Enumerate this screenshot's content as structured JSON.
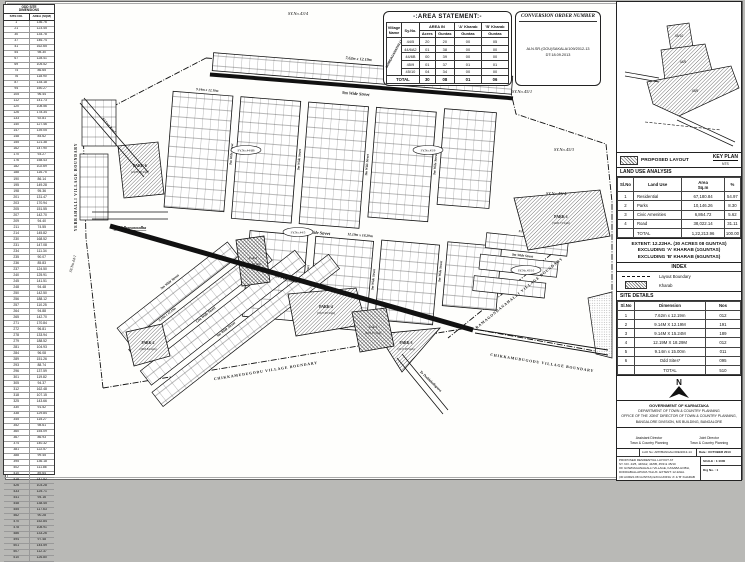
{
  "left_table": {
    "title_l1": "ODD SITE",
    "title_l2": "DIMENSIONS",
    "col_site": "SITE NO.",
    "col_area": "AREA (SQM)",
    "rows": [
      [
        "1",
        "136.76"
      ],
      [
        "21",
        "123.45"
      ],
      [
        "30",
        "134.78"
      ],
      [
        "37",
        "146.74"
      ],
      [
        "41",
        "162.65"
      ],
      [
        "54",
        "98.30"
      ],
      [
        "67",
        "128.41"
      ],
      [
        "69",
        "105.52"
      ],
      [
        "74",
        "86.65"
      ],
      [
        "76",
        "118.90"
      ],
      [
        "87",
        "134.18"
      ],
      [
        "94",
        "150.27"
      ],
      [
        "105",
        "96.44"
      ],
      [
        "112",
        "141.73"
      ],
      [
        "120",
        "108.56"
      ],
      [
        "126",
        "178.34"
      ],
      [
        "133",
        "92.81"
      ],
      [
        "140",
        "127.46"
      ],
      [
        "147",
        "139.05"
      ],
      [
        "148",
        "84.62"
      ],
      [
        "155",
        "121.38"
      ],
      [
        "162",
        "147.90"
      ],
      [
        "170",
        "93.27"
      ],
      [
        "176",
        "158.43"
      ],
      [
        "182",
        "102.69"
      ],
      [
        "188",
        "116.75"
      ],
      [
        "190",
        "86.14"
      ],
      [
        "195",
        "149.28"
      ],
      [
        "198",
        "95.36"
      ],
      [
        "201",
        "131.47"
      ],
      [
        "203",
        "170.94"
      ],
      [
        "205",
        "151.55"
      ],
      [
        "207",
        "142.70"
      ],
      [
        "209",
        "94.40"
      ],
      [
        "211",
        "74.55"
      ],
      [
        "214",
        "145.82"
      ],
      [
        "230",
        "168.52"
      ],
      [
        "231",
        "147.08"
      ],
      [
        "234",
        "111.34"
      ],
      [
        "235",
        "90.07"
      ],
      [
        "236",
        "85.83"
      ],
      [
        "237",
        "124.50"
      ],
      [
        "240",
        "125.91"
      ],
      [
        "245",
        "141.51"
      ],
      [
        "248",
        "94.48"
      ],
      [
        "250",
        "142.50"
      ],
      [
        "256",
        "188.12"
      ],
      [
        "257",
        "110.25"
      ],
      [
        "264",
        "94.88"
      ],
      [
        "265",
        "142.70"
      ],
      [
        "271",
        "170.84"
      ],
      [
        "272",
        "96.81"
      ],
      [
        "278",
        "133.94"
      ],
      [
        "279",
        "188.52"
      ],
      [
        "281",
        "104.93"
      ],
      [
        "284",
        "96.08"
      ],
      [
        "289",
        "151.26"
      ],
      [
        "293",
        "88.74"
      ],
      [
        "296",
        "137.59"
      ],
      [
        "301",
        "119.82"
      ],
      [
        "305",
        "94.37"
      ],
      [
        "312",
        "162.48"
      ],
      [
        "318",
        "107.15"
      ],
      [
        "325",
        "143.66"
      ],
      [
        "330",
        "91.52"
      ],
      [
        "338",
        "129.84"
      ],
      [
        "345",
        "115.27"
      ],
      [
        "352",
        "98.61"
      ],
      [
        "360",
        "154.09"
      ],
      [
        "367",
        "86.93"
      ],
      [
        "374",
        "140.32"
      ],
      [
        "381",
        "122.57"
      ],
      [
        "388",
        "99.45"
      ],
      [
        "395",
        "136.18"
      ],
      [
        "402",
        "111.86"
      ],
      [
        "410",
        "89.64"
      ],
      [
        "418",
        "147.52"
      ],
      [
        "426",
        "103.28"
      ],
      [
        "433",
        "125.71"
      ],
      [
        "441",
        "94.16"
      ],
      [
        "448",
        "138.45"
      ],
      [
        "455",
        "117.63"
      ],
      [
        "462",
        "90.28"
      ],
      [
        "470",
        "152.84"
      ],
      [
        "478",
        "108.91"
      ],
      [
        "486",
        "133.26"
      ],
      [
        "494",
        "97.48"
      ],
      [
        "501",
        "144.59"
      ],
      [
        "507",
        "112.37"
      ],
      [
        "510",
        "126.80"
      ]
    ]
  },
  "area_statement": {
    "title": "-:AREA STATEMENT:-",
    "col_village": "Village Name",
    "col_syno": "Sy.No.",
    "col_area_in": "AREA IN",
    "col_a_kharab": "'A' Kharab",
    "col_b_kharab": "'B' Kharab",
    "col_acres": "Acres",
    "col_guntas": "Guntas",
    "village": "GOWDAGANAHALLI",
    "rows": [
      [
        "44/5",
        "20",
        "20",
        "00",
        "05"
      ],
      [
        "44/6A2",
        "01",
        "38",
        "00",
        "00"
      ],
      [
        "44/6B",
        "00",
        "39",
        "00",
        "00"
      ],
      [
        "45/9",
        "01",
        "37",
        "01",
        "01"
      ],
      [
        "45/10",
        "04",
        "34",
        "00",
        "00"
      ],
      [
        "TOTAL",
        "30",
        "08",
        "01",
        "06"
      ]
    ]
  },
  "conversion_order": {
    "title": "CONVERSION ORDER NUMBER",
    "text": "ALN.SR.(GOU)SAKALA/109/2012-13 DT:18.09.2013"
  },
  "map": {
    "sy_labels": [
      "SY.No.43/4",
      "SY.No.43/3",
      "SY.No.45/1",
      "SY.No.45/3",
      "SY.No.45/4",
      "SY.No.44/1"
    ],
    "oval_labels": [
      "SY.No.44/6B",
      "SY.No.44/5",
      "SY.No.45/9",
      "SY.No.45/10"
    ],
    "streets": {
      "s9": "9m Wide Street",
      "s12": "12m Wide Street"
    },
    "dims": [
      "7.62m x 12.19m",
      "9.14m x 12.19m",
      "9.14m x 15.24m",
      "12.19m x 18.29m"
    ],
    "boundaries": {
      "left": "YERRAHALLI VILLAGE BOUNDARY",
      "bottom": "CHIKKAMUDUGODU VILLAGE BOUNDARY",
      "right": "RAMAGONDANAHALLI VILLAGE BOUNDARY"
    },
    "roads": {
      "left": "To Vidhanasoudha",
      "diag": "83 Feet Road",
      "main": "80 Feet Road",
      "bottom": "To Doddaballapura"
    },
    "parks": [
      {
        "name": "PARK-1",
        "area": "(3226.73 Sqm)"
      },
      {
        "name": "PARK-2",
        "area": "(2063.84 Sqm)"
      },
      {
        "name": "PARK-3",
        "area": "(2317.08 Sqm)"
      },
      {
        "name": "PARK-4",
        "area": "(3327.08 Sqm)"
      },
      {
        "name": "PARK-6",
        "area": "(2478.08 Sqm)"
      }
    ],
    "civic": [
      {
        "name": "C.A-1",
        "area": "(2055.37 Sqm)"
      },
      {
        "name": "C.A-2",
        "area": "(2594.94 Sqm)"
      }
    ]
  },
  "key_plan": {
    "title": "KEY PLAN",
    "scale": "NTS",
    "labels": [
      "45/10",
      "44/5",
      "45/9"
    ]
  },
  "legend": {
    "proposed": "PROPOSED LAYOUT"
  },
  "land_use": {
    "title": "LAND USE ANALYSIS",
    "col_slno": "Sl.No",
    "col_landuse": "Land Use",
    "col_area": "Area",
    "col_area2": "Sq.m",
    "col_pct": "%",
    "rows": [
      [
        "1",
        "Residential",
        "67,180.84",
        "54.97"
      ],
      [
        "2",
        "Parks",
        "10,146.26",
        "8.30"
      ],
      [
        "3",
        "Civic Amenities",
        "6,864.72",
        "5.62"
      ],
      [
        "4",
        "Road",
        "38,022.14",
        "31.11"
      ],
      [
        "",
        "TOTAL",
        "1,22,213.96",
        "100.00"
      ]
    ]
  },
  "extent": {
    "l1": "EXTENT: 12.22HA. (30 ACRES 08 GUNTAS)",
    "l2": "EXCLUDING 'A' KHARAB (1GUNTAS)",
    "l3": "EXCLUDING 'B' KHARAB (6GUNTAS)"
  },
  "index": {
    "title": "INDEX",
    "boundary": "Layout Boundary",
    "kharab": "Kharab"
  },
  "site_details": {
    "title": "SITE DETAILS",
    "col_slno": "Sl.No",
    "col_dim": "Dimension",
    "col_nos": "Nos",
    "rows": [
      [
        "1",
        "7.62m x 12.19m",
        "012"
      ],
      [
        "2",
        "9.14M X 12.19M",
        "191"
      ],
      [
        "3",
        "9.14M X 15.24M",
        "189"
      ],
      [
        "4",
        "12.19M X 18.29M",
        "012"
      ],
      [
        "5",
        "9.14m x 15.00m",
        "011"
      ],
      [
        "6",
        "Odd Sites*",
        "095"
      ],
      [
        "",
        "TOTAL",
        "510"
      ]
    ]
  },
  "north": {
    "label": "N"
  },
  "govt": {
    "l1": "GOVERNMENT OF KARNATAKA",
    "l2": "DEPARTMENT OF TOWN & COUNTRY PLANNING",
    "l3": "OFFICE OF THE JOINT DIRECTOR OF TOWN & COUNTRY PLANNING,",
    "l4": "BANGALORE DIVISION, MS BUILDING, BANGALORE"
  },
  "signatures": {
    "left_title": "Assistant Director",
    "left_sub": "Town & Country Planning",
    "right_title": "Joint Director",
    "right_sub": "Town & Country Planning"
  },
  "title_block": {
    "lho": "LHO No: APP/BANGALORE/2013-14",
    "date": "Date : OCTOBER 2013",
    "desc_l1": "PROPOSED RESIDENTIAL LAYOUT AT",
    "desc_l2": "SY. NO. 44/5, 44/6A2, 44/6B, 45/9 & 45/10",
    "desc_l3": "OF GOWDAGANAHALLI VILLAGE, KASABA HOBLI,",
    "desc_l4": "DODDABALLAPURA TALUK. EXTENT: 12.22HA.",
    "desc_l5": "(30 ACRES 08 GUNTAS) EXCLUDING 'A' & 'B' KHARAB",
    "scale": "SCALE : 1:1000",
    "drg": "Drg No. : 1"
  }
}
